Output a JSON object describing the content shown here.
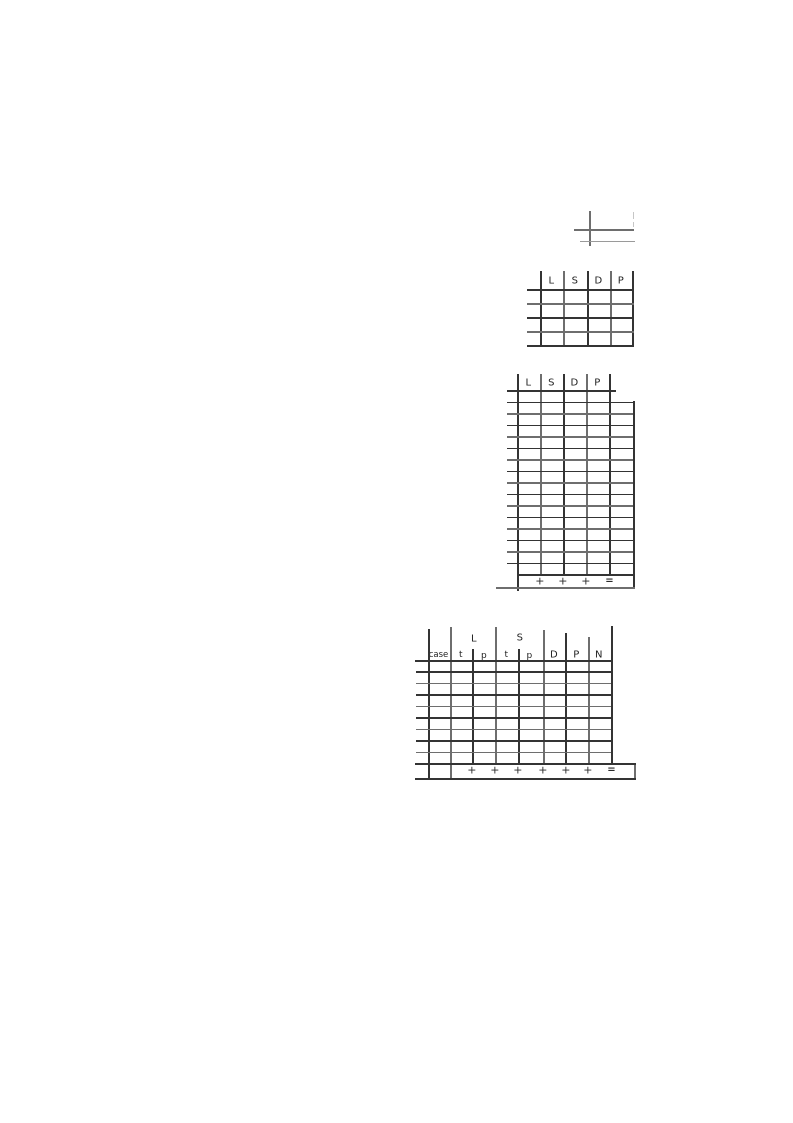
{
  "document": {
    "kind": "scanned page with empty scoring grids",
    "background": "#ffffff",
    "ink_color": "#3c3c3c"
  },
  "tables": {
    "small_table": {
      "headers": [
        "L",
        "S",
        "D",
        "P"
      ],
      "row_count": 4
    },
    "tall_table": {
      "headers": [
        "L",
        "S",
        "D",
        "P"
      ],
      "row_count": 16,
      "summary_row": {
        "operators": [
          "+",
          "+",
          "+",
          "="
        ]
      }
    },
    "wide_table": {
      "group_headers": [
        "L",
        "S"
      ],
      "column_headers": [
        "case",
        "t",
        "p",
        "t",
        "p",
        "D",
        "P",
        "N"
      ],
      "row_count": 9,
      "summary_row": {
        "operators": [
          "+",
          "+",
          "+",
          "+",
          "+",
          "+",
          "="
        ]
      }
    }
  }
}
